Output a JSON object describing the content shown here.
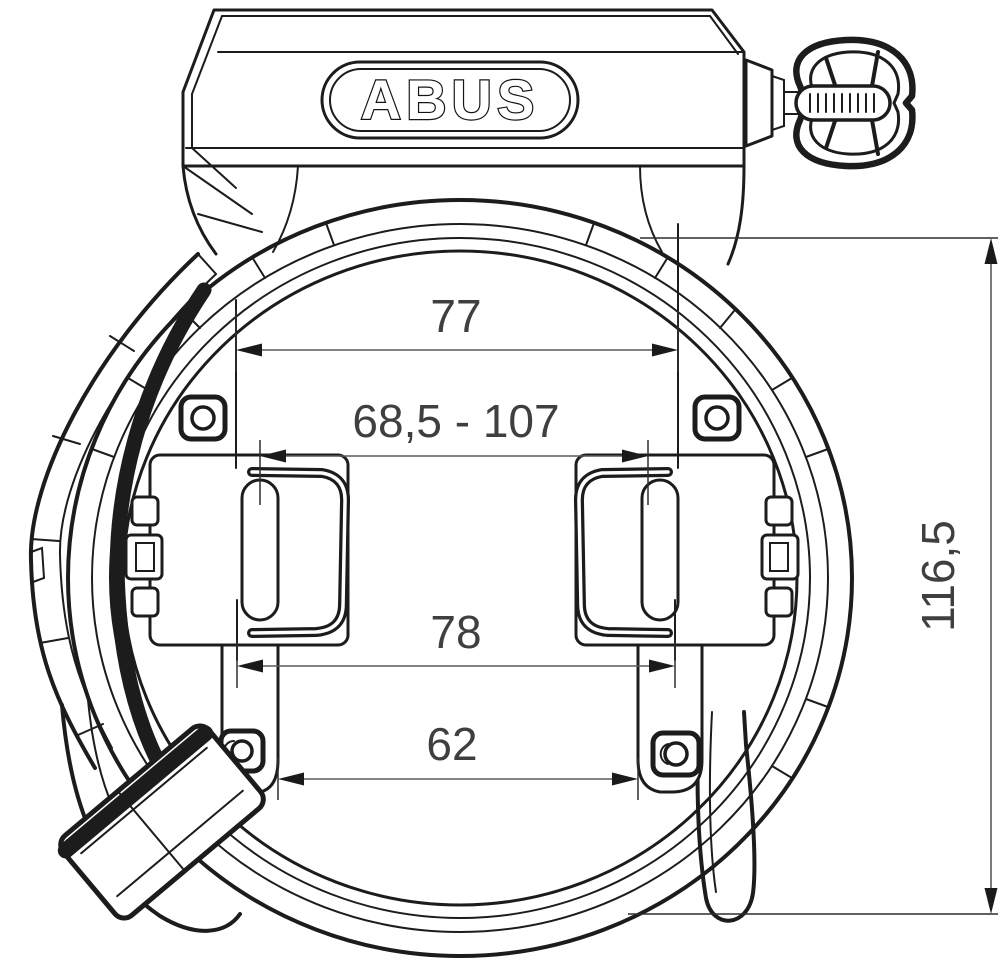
{
  "drawing": {
    "brand_logo": "ABUS",
    "dimensions": {
      "top_width": "77",
      "mount_range": "68,5 - 107",
      "mid_width": "78",
      "bottom_width": "62",
      "height": "116,5"
    }
  }
}
